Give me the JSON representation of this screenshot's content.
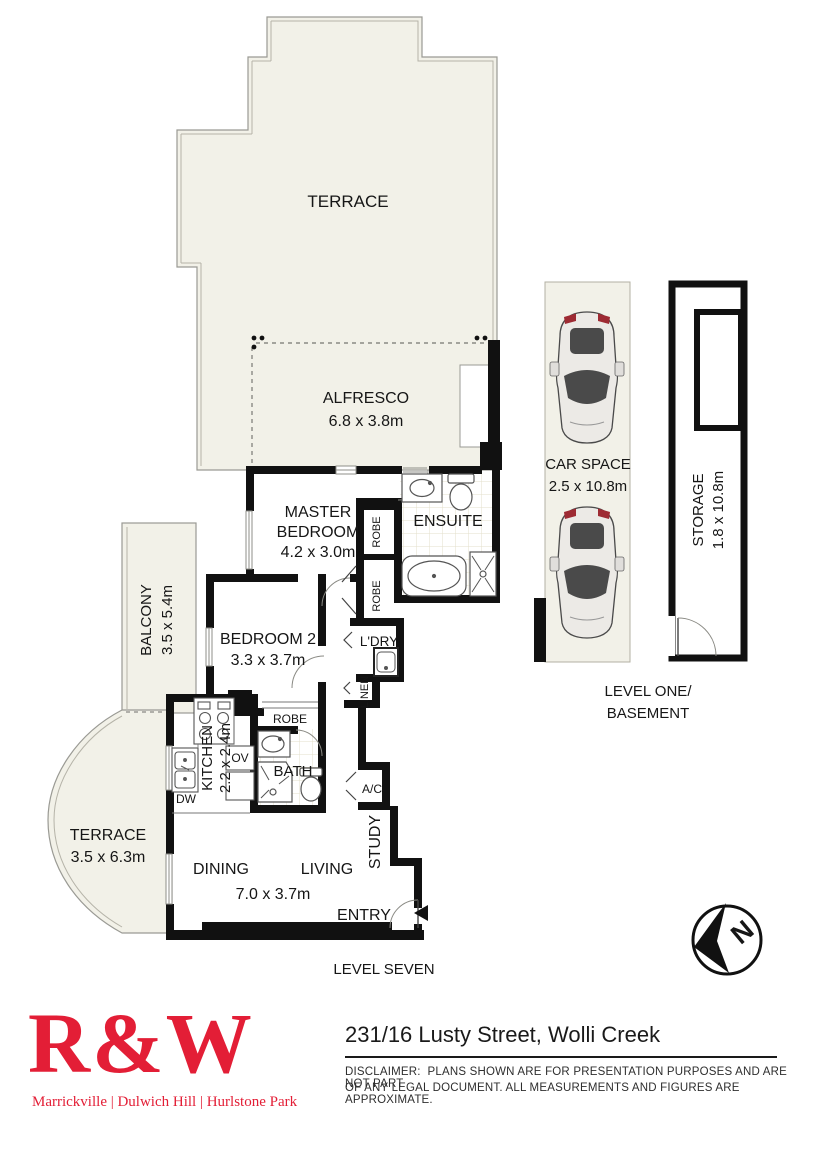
{
  "plan": {
    "colors": {
      "outdoor_fill": "#f2f1e8",
      "wall": "#111111",
      "thin_line": "#999999",
      "tile_line": "#e3dfcb",
      "car_red": "#9e2b33",
      "car_glass": "#4a4a4a",
      "car_body": "#eceae6"
    },
    "labels": {
      "terrace_top": "TERRACE",
      "alfresco": "ALFRESCO",
      "alfresco_dims": "6.8 x 3.8m",
      "master_1": "MASTER",
      "master_2": "BEDROOM",
      "master_dims": "4.2 x 3.0m",
      "ensuite": "ENSUITE",
      "robe": "ROBE",
      "balcony": "BALCONY",
      "balcony_dims": "3.5 x 5.4m",
      "bedroom2": "BEDROOM 2",
      "bedroom2_dims": "3.3 x 3.7m",
      "ldry": "L'DRY",
      "linen": "LINEN",
      "kitchen": "KITCHEN",
      "kitchen_dims": "2.2 x 2.4m",
      "dw": "DW",
      "ov": "OV",
      "bath": "BATH",
      "ac": "A/C",
      "study": "STUDY",
      "terrace_left": "TERRACE",
      "terrace_left_dims": "3.5 x 6.3m",
      "dining": "DINING",
      "living": "LIVING",
      "living_dims": "7.0 x 3.7m",
      "entry": "ENTRY",
      "level_seven": "LEVEL SEVEN",
      "car_space": "CAR SPACE",
      "car_space_dims": "2.5 x 10.8m",
      "storage": "STORAGE",
      "storage_dims": "1.8 x 10.8m",
      "level_one": "LEVEL ONE/",
      "basement": "BASEMENT",
      "compass_n": "N"
    }
  },
  "footer": {
    "brand": "R&W",
    "brand_color": "#e31e36",
    "brand_tagline": "Marrickville | Dulwich Hill | Hurlstone Park",
    "address": "231/16 Lusty Street, Wolli Creek",
    "disclaimer_1": "DISCLAIMER:  PLANS SHOWN ARE FOR PRESENTATION PURPOSES AND ARE NOT PART",
    "disclaimer_2": "OF ANY LEGAL DOCUMENT. ALL MEASUREMENTS AND FIGURES ARE APPROXIMATE."
  }
}
